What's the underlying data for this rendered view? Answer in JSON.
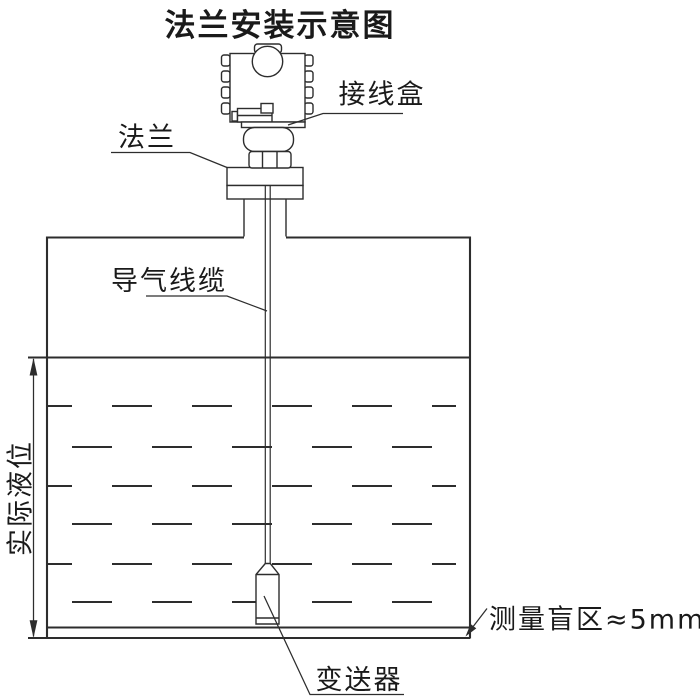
{
  "title": "法兰安装示意图",
  "callouts": {
    "junction_box": "接线盒",
    "flange": "法兰",
    "air_guide_cable": "导气线缆",
    "actual_liquid_level": "实际液位",
    "blind_zone": "测量盲区≈5mm",
    "transmitter": "变送器"
  },
  "colors": {
    "line": "#2d2d2d",
    "text": "#1a1a1a",
    "background": "#ffffff"
  }
}
